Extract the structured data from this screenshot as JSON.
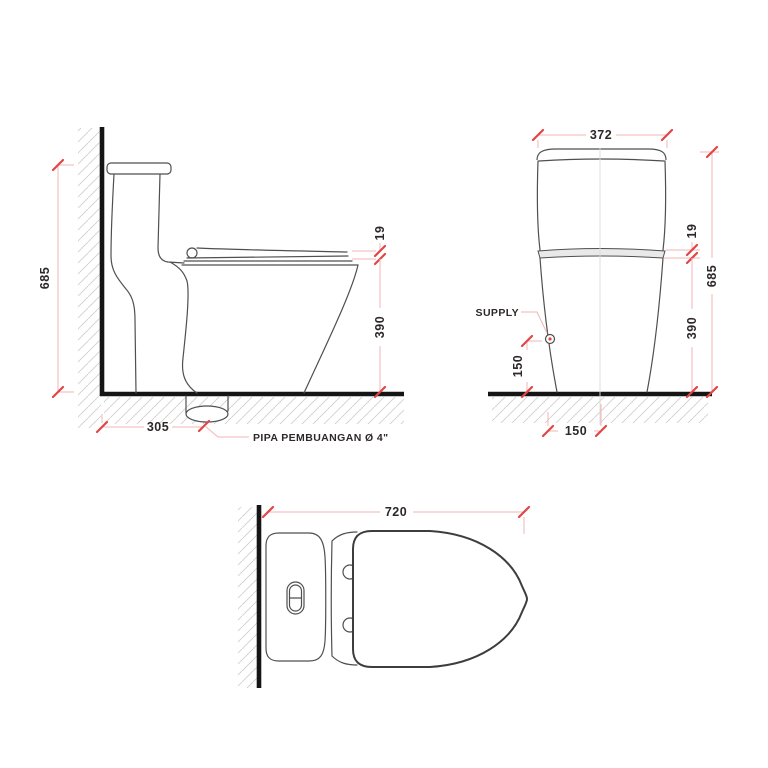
{
  "document_type": "toilet-technical-drawing",
  "colors": {
    "background": "#ffffff",
    "outline": "#4f4f4f",
    "wall_floor": "#151515",
    "dimension_line": "#f2b4b4",
    "tick": "#e24545",
    "dimension_text": "#2e2929",
    "hatch": "#cfcfcf"
  },
  "side_view": {
    "dim_height": "685",
    "dim_depth": "305",
    "dim_seat_thickness": "19",
    "dim_rim_height": "390",
    "pipe_label": "PIPA PEMBUANGAN Ø 4\""
  },
  "front_view": {
    "dim_width": "372",
    "dim_seat_thickness": "19",
    "dim_height": "685",
    "dim_rim_height": "390",
    "dim_supply_height": "150",
    "dim_supply_offset": "150",
    "supply_label": "SUPPLY"
  },
  "top_view": {
    "dim_length": "720"
  }
}
